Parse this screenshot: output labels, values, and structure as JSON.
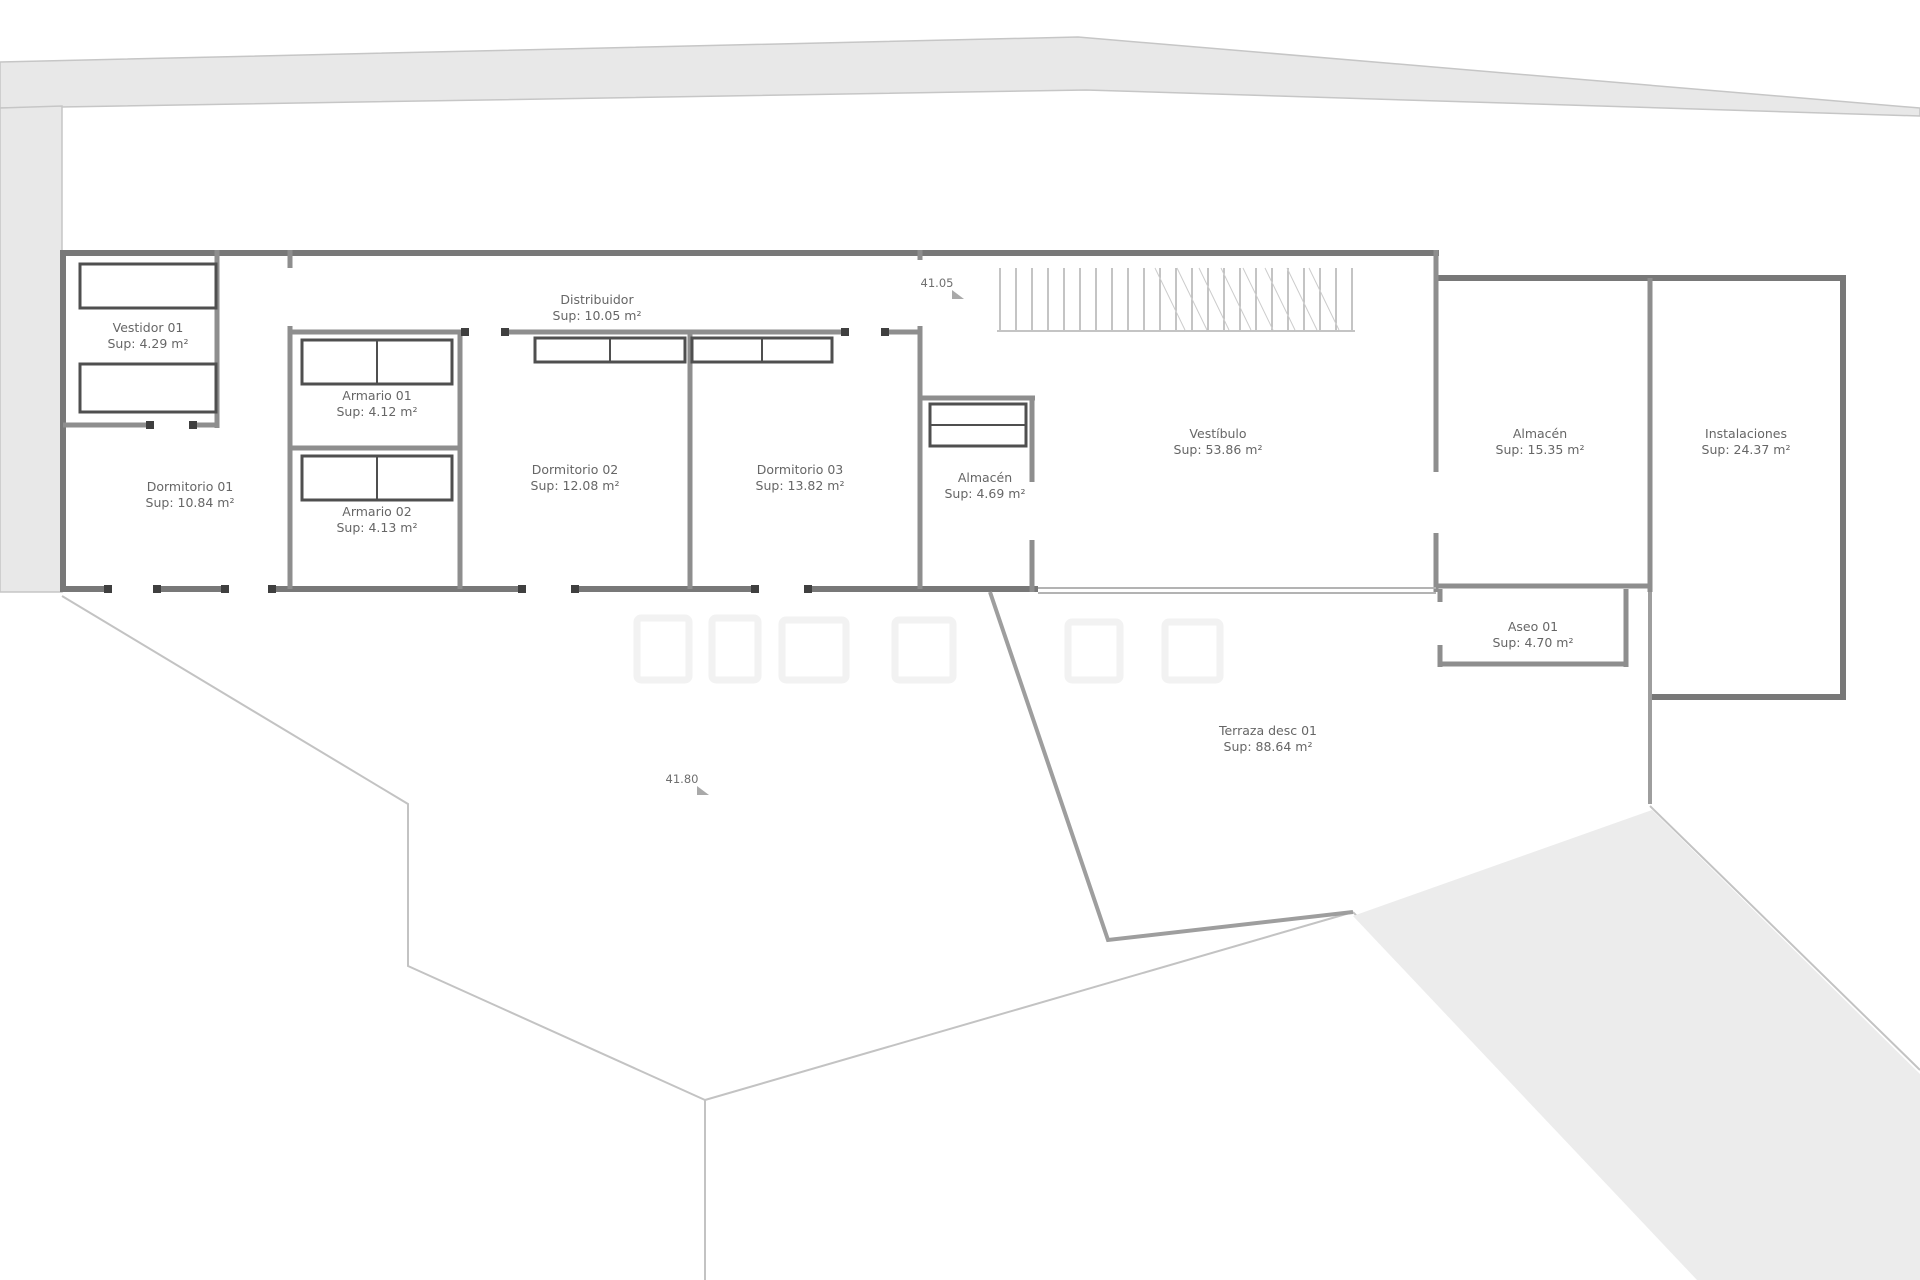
{
  "plan": {
    "rooms": [
      {
        "id": "vestidor-01",
        "name": "Vestidor 01",
        "area": "Sup:  4.29 m²"
      },
      {
        "id": "dormitorio-01",
        "name": "Dormitorio 01",
        "area": "Sup:  10.84 m²"
      },
      {
        "id": "armario-01",
        "name": "Armario 01",
        "area": "Sup:  4.12 m²"
      },
      {
        "id": "armario-02",
        "name": "Armario 02",
        "area": "Sup:  4.13 m²"
      },
      {
        "id": "dormitorio-02",
        "name": "Dormitorio 02",
        "area": "Sup:  12.08 m²"
      },
      {
        "id": "distribuidor",
        "name": "Distribuidor",
        "area": "Sup:  10.05 m²"
      },
      {
        "id": "dormitorio-03",
        "name": "Dormitorio 03",
        "area": "Sup:  13.82 m²"
      },
      {
        "id": "almacen-01",
        "name": "Almacén",
        "area": "Sup:  4.69 m²"
      },
      {
        "id": "vestibulo",
        "name": "Vestíbulo",
        "area": "Sup:  53.86 m²"
      },
      {
        "id": "almacen-02",
        "name": "Almacén",
        "area": "Sup:  15.35 m²"
      },
      {
        "id": "instalaciones",
        "name": "Instalaciones",
        "area": "Sup:  24.37 m²"
      },
      {
        "id": "aseo-01",
        "name": "Aseo 01",
        "area": "Sup:  4.70 m²"
      },
      {
        "id": "terraza",
        "name": "Terraza desc 01",
        "area": "Sup:  88.64 m²"
      }
    ],
    "levels": [
      {
        "id": "level-upper",
        "value": "41.05"
      },
      {
        "id": "level-lower",
        "value": "41.80"
      }
    ]
  }
}
